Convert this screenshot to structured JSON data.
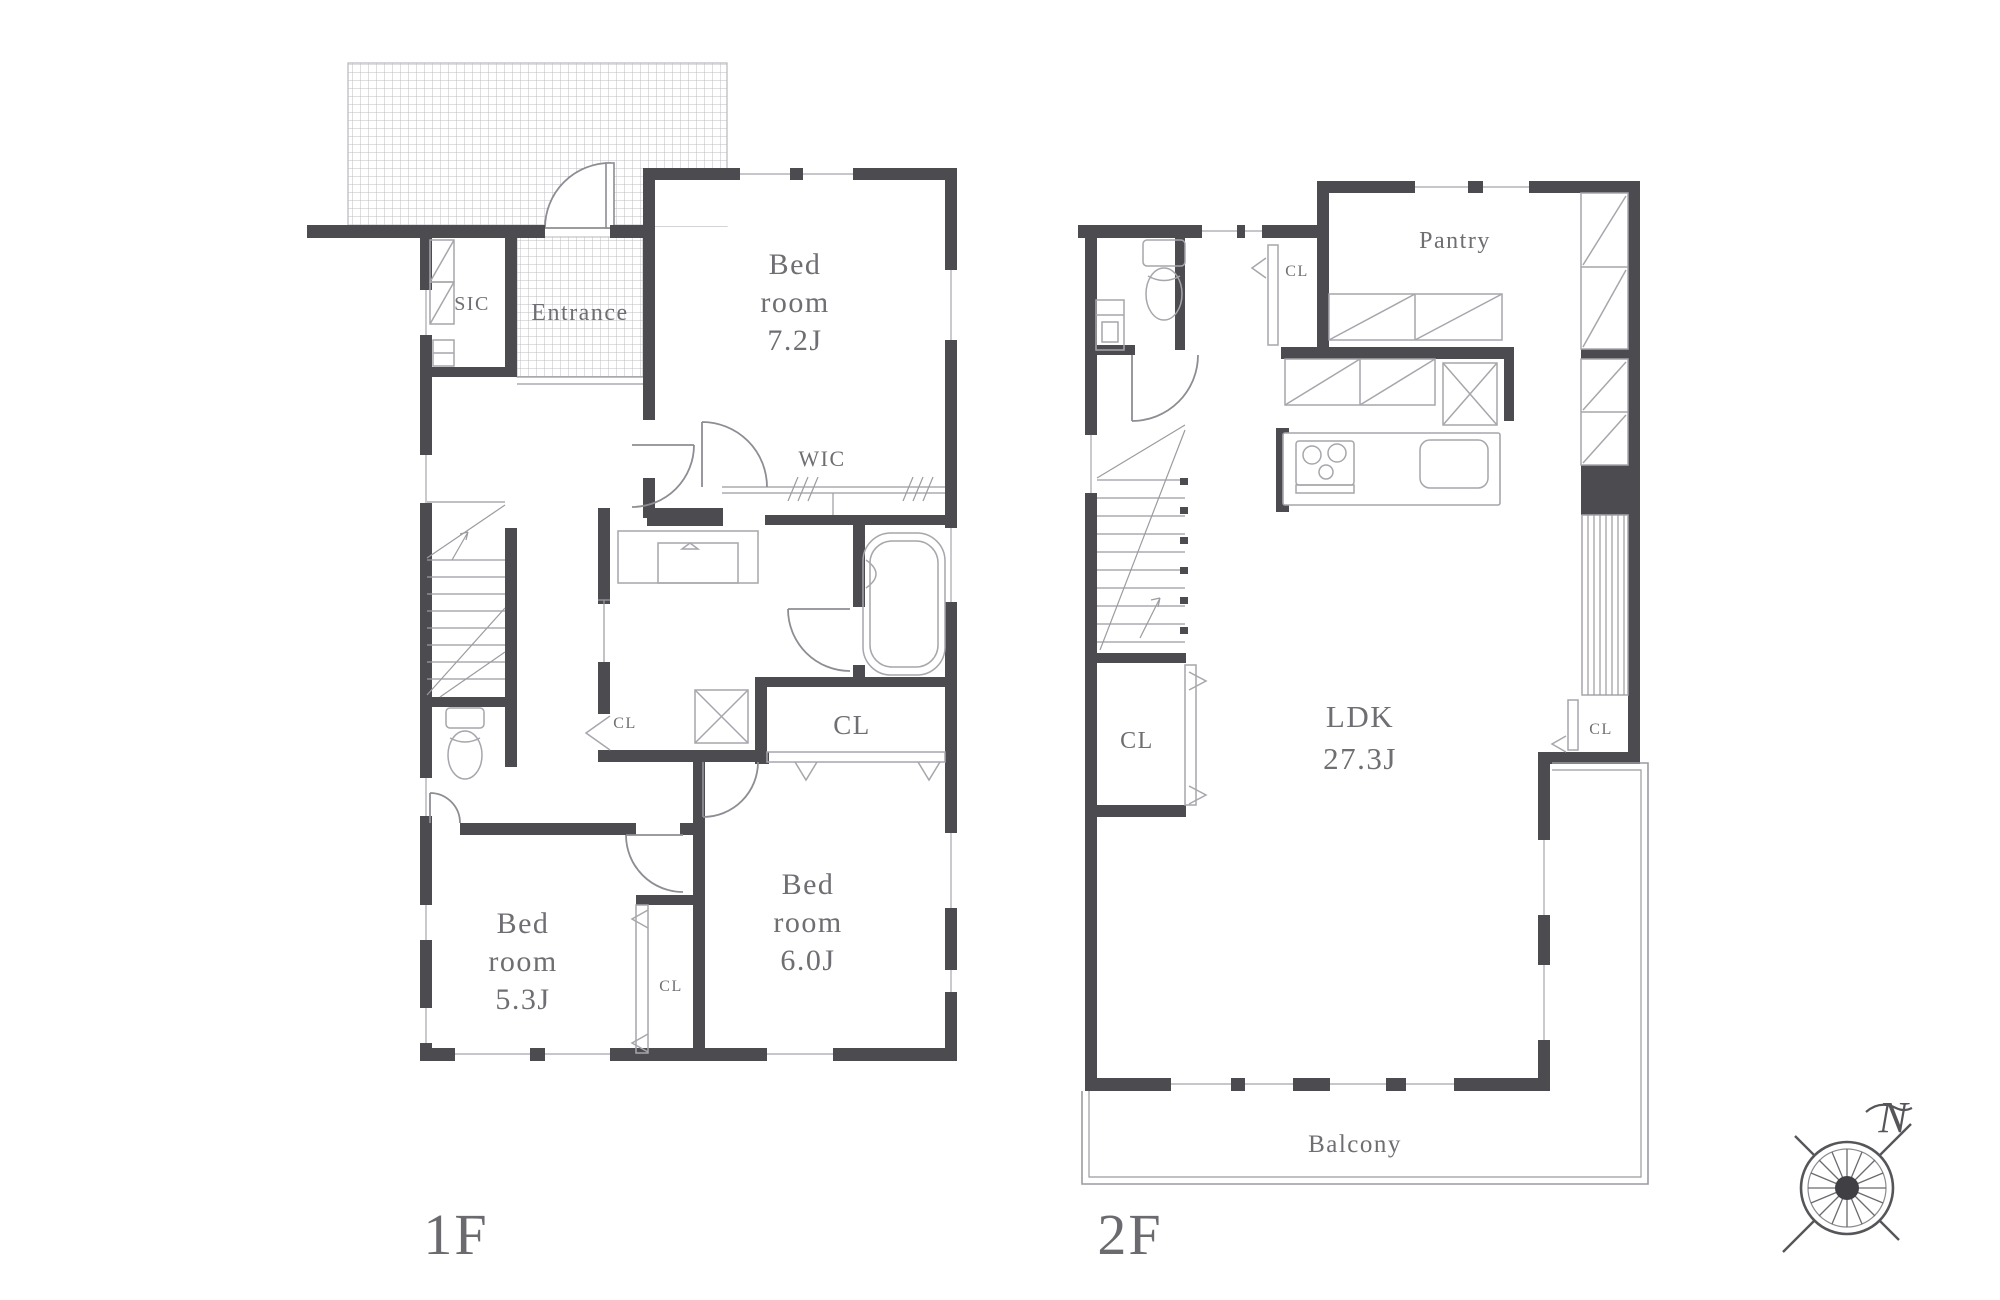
{
  "colors": {
    "wall": "#4b4b50",
    "line": "#9b9ba1",
    "text": "#6e6e73",
    "bg": "#ffffff"
  },
  "f1": {
    "floor_label": "1F",
    "sic": "SIC",
    "entrance": "Entrance",
    "bedroom_7_2": [
      "Bed",
      "room",
      "7.2J"
    ],
    "wic": "WIC",
    "cl_hall": "CL",
    "cl_bedroom6": "CL",
    "cl_bedroom5": "CL",
    "bedroom_5_3": [
      "Bed",
      "room",
      "5.3J"
    ],
    "bedroom_6_0": [
      "Bed",
      "room",
      "6.0J"
    ]
  },
  "f2": {
    "floor_label": "2F",
    "pantry": "Pantry",
    "cl_hall": "CL",
    "cl_stairs": "CL",
    "ldk": [
      "LDK",
      "27.3J"
    ],
    "cl_side": "CL",
    "balcony": "Balcony"
  },
  "compass": {
    "north": "N"
  }
}
